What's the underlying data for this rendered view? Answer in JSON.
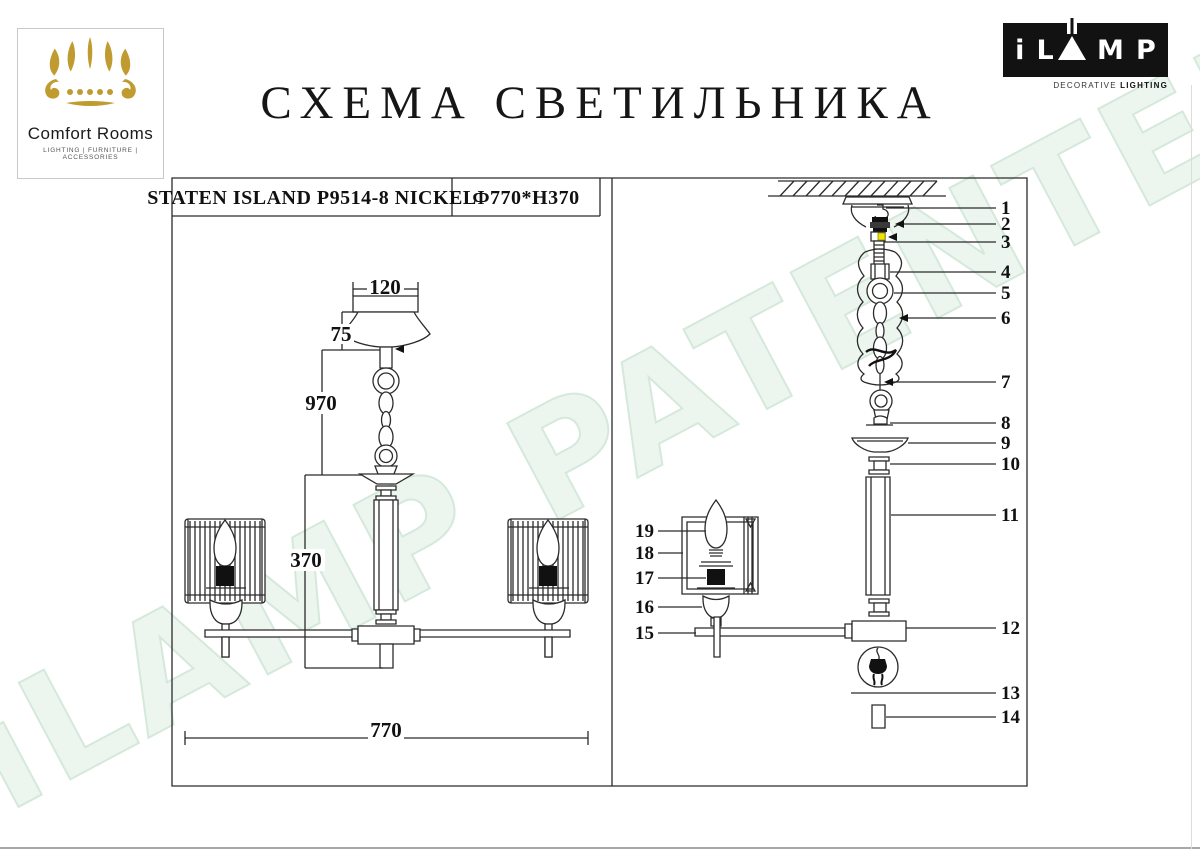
{
  "title": "СХЕМА СВЕТИЛЬНИКА",
  "watermark": "iLAMP PATENTED",
  "logos": {
    "comfort_rooms": {
      "name": "Comfort Rooms",
      "tagline": "LIGHTING | FURNITURE | ACCESSORIES"
    },
    "ilamp": {
      "left": "iL",
      "right": "MP",
      "tagline_a": "DECORATIVE ",
      "tagline_b": "LIGHTING"
    }
  },
  "spec": {
    "model": "STATEN ISLAND P9514-8 NICKEL",
    "size": "Ф770*H370"
  },
  "dims": {
    "canopy_width": "120",
    "canopy_height": "75",
    "chain_drop": "970",
    "body_height": "370",
    "total_width": "770"
  },
  "part_labels": {
    "right": [
      "1",
      "2",
      "3",
      "4",
      "5",
      "6",
      "7",
      "8",
      "9",
      "10",
      "11",
      "12",
      "13",
      "14"
    ],
    "left": [
      "19",
      "18",
      "17",
      "16",
      "15"
    ]
  },
  "colors": {
    "line": "#2b2b2b",
    "gold": "#bf9b30",
    "highlight_yellow": "#f2e305",
    "logo_black": "#121212",
    "watermark_fill": "#ecf5ee",
    "watermark_stroke": "#d5e9db"
  }
}
